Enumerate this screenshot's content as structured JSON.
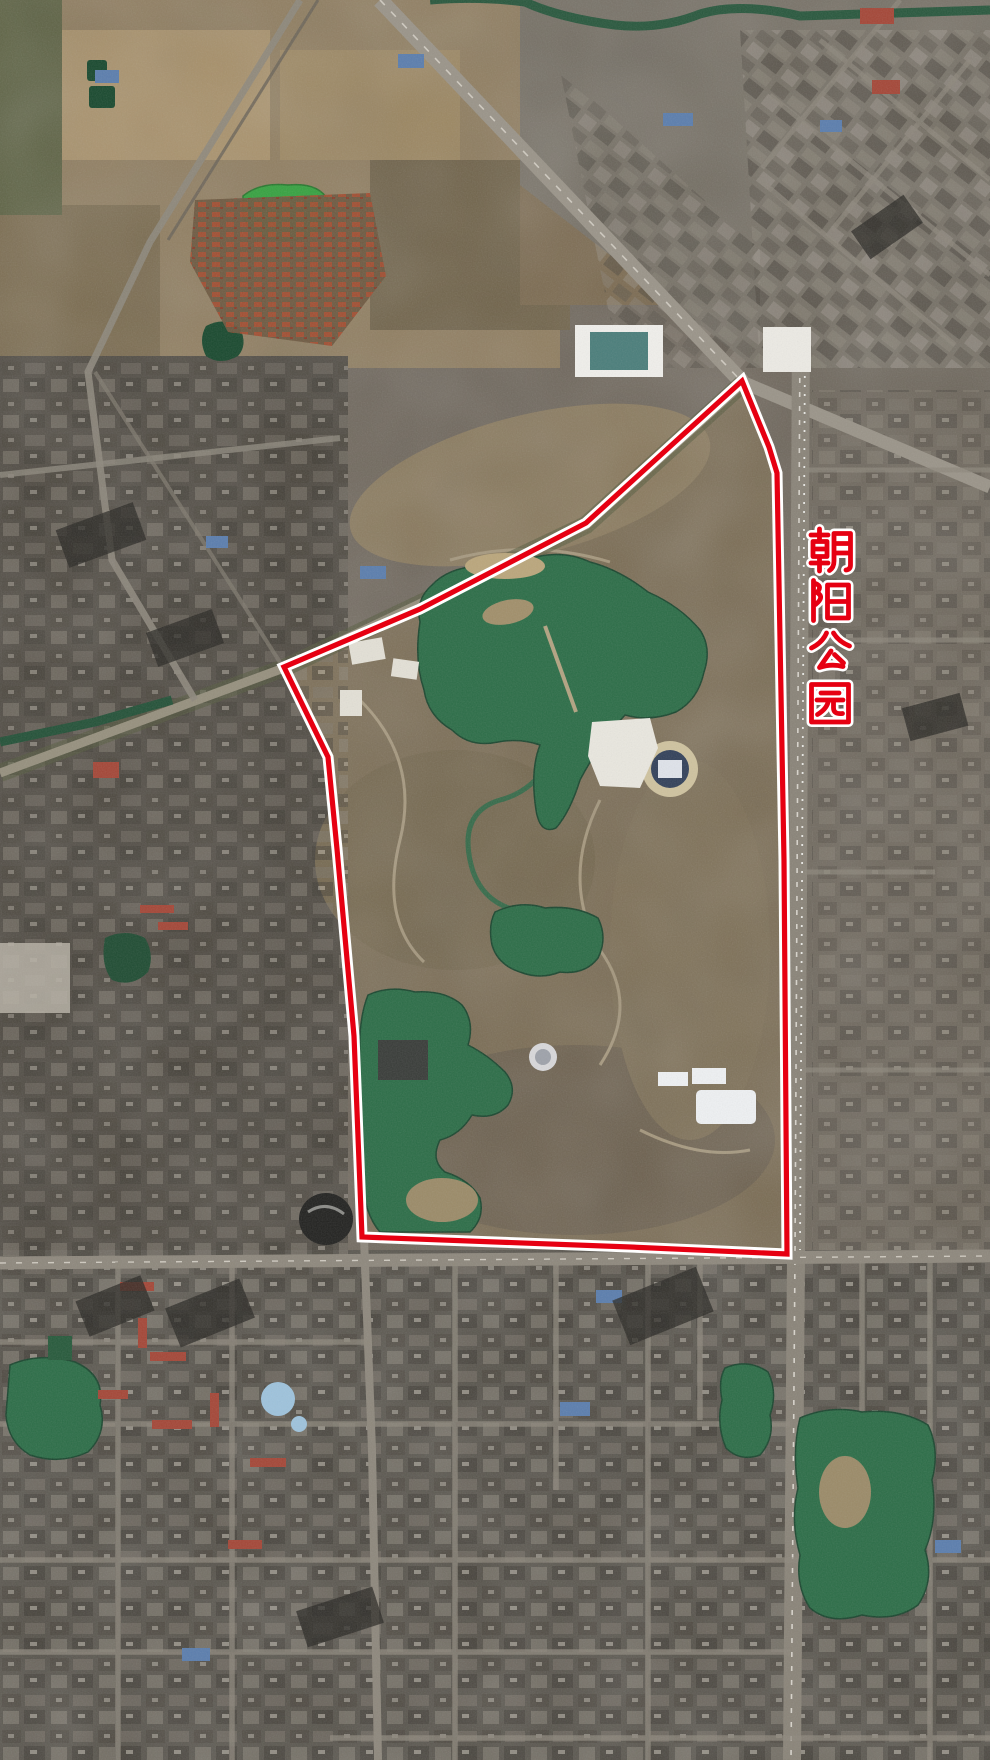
{
  "map": {
    "type": "satellite-imagery",
    "annotation": {
      "label": "朝阳公园",
      "label_chars": [
        "朝",
        "阳",
        "公",
        "园"
      ],
      "label_color": "#e60012",
      "label_outline_color": "#ffffff",
      "boundary_color": "#e60012",
      "boundary_casing_color": "#ffffff",
      "boundary_points": "742,381 769,447 777,473 784,860 787,1254 630,1247 362,1237 354,1036 337,849 328,757 284,667 420,609 586,523"
    },
    "imagery_colors": {
      "water_green": "#2f6f4a",
      "bright_pond_green": "#3aa344",
      "parkland_brown": "#7b6d55",
      "urban_gray": "#57534b",
      "road_gray": "#9b958a"
    }
  }
}
